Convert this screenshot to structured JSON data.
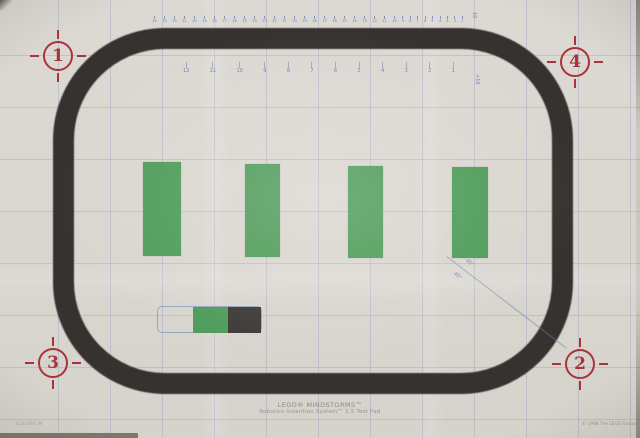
{
  "pad": {
    "title_line1": "LEGO® MINDSTORMS™",
    "title_line2": "Robotics Invention System™ 1.5 Test Pad",
    "part_number": "4151465 IN",
    "copyright": "© 1998 The LEGO Group"
  },
  "colors": {
    "pad_background": "#dad6d0",
    "track_black": "#363230",
    "bar_green": "#4d9b58",
    "marker_red": "#a93338",
    "print_blue": "#6d82b2",
    "start_black": "#3c3835"
  },
  "figure": {
    "track": {
      "left": 53,
      "top": 28,
      "width": 520,
      "height": 366,
      "thickness": 21,
      "corner_radius": 112
    },
    "corner_markers": [
      {
        "label": "1",
        "cx": 58,
        "cy": 56
      },
      {
        "label": "4",
        "cx": 575,
        "cy": 62
      },
      {
        "label": "3",
        "cx": 53,
        "cy": 363
      },
      {
        "label": "2",
        "cx": 580,
        "cy": 364
      }
    ],
    "green_bars": [
      {
        "x": 143,
        "y": 162,
        "w": 38,
        "h": 94
      },
      {
        "x": 245,
        "y": 164,
        "w": 35,
        "h": 93
      },
      {
        "x": 348,
        "y": 166,
        "w": 35,
        "h": 92
      },
      {
        "x": 452,
        "y": 167,
        "w": 36,
        "h": 91
      }
    ],
    "start_marker": {
      "outline": {
        "x": 157,
        "y": 306,
        "w": 105,
        "h": 27
      },
      "green": {
        "x": 193,
        "y": 307,
        "w": 35,
        "h": 26
      },
      "black": {
        "x": 228,
        "y": 307,
        "w": 33,
        "h": 26
      }
    },
    "diagonal": {
      "x1": 447,
      "y1": 256,
      "length": 151,
      "angle_deg": 37.5
    },
    "angle_labels": [
      {
        "text": "45°",
        "x": 465,
        "y": 261
      },
      {
        "text": "45°",
        "x": 453,
        "y": 274
      }
    ],
    "top_ruler_labels": [
      "34",
      "33",
      "32",
      "31",
      "30",
      "29",
      "28",
      "27",
      "26",
      "25",
      "24",
      "23",
      "22",
      "21",
      "20",
      "19",
      "18",
      "17",
      "16",
      "15",
      "14",
      "13",
      "12",
      "11",
      "10",
      "9",
      "8",
      "7",
      "6",
      "5",
      "4",
      "3",
      "2",
      "1"
    ],
    "inner_scale_labels": [
      "12",
      "11",
      "10",
      "9",
      "8",
      "7",
      "6",
      "5",
      "4",
      "3",
      "2",
      "1"
    ],
    "side_labels": [
      {
        "text": "10",
        "x": 476,
        "y": 12
      },
      {
        "text": "+10",
        "x": 479,
        "y": 74
      }
    ]
  }
}
